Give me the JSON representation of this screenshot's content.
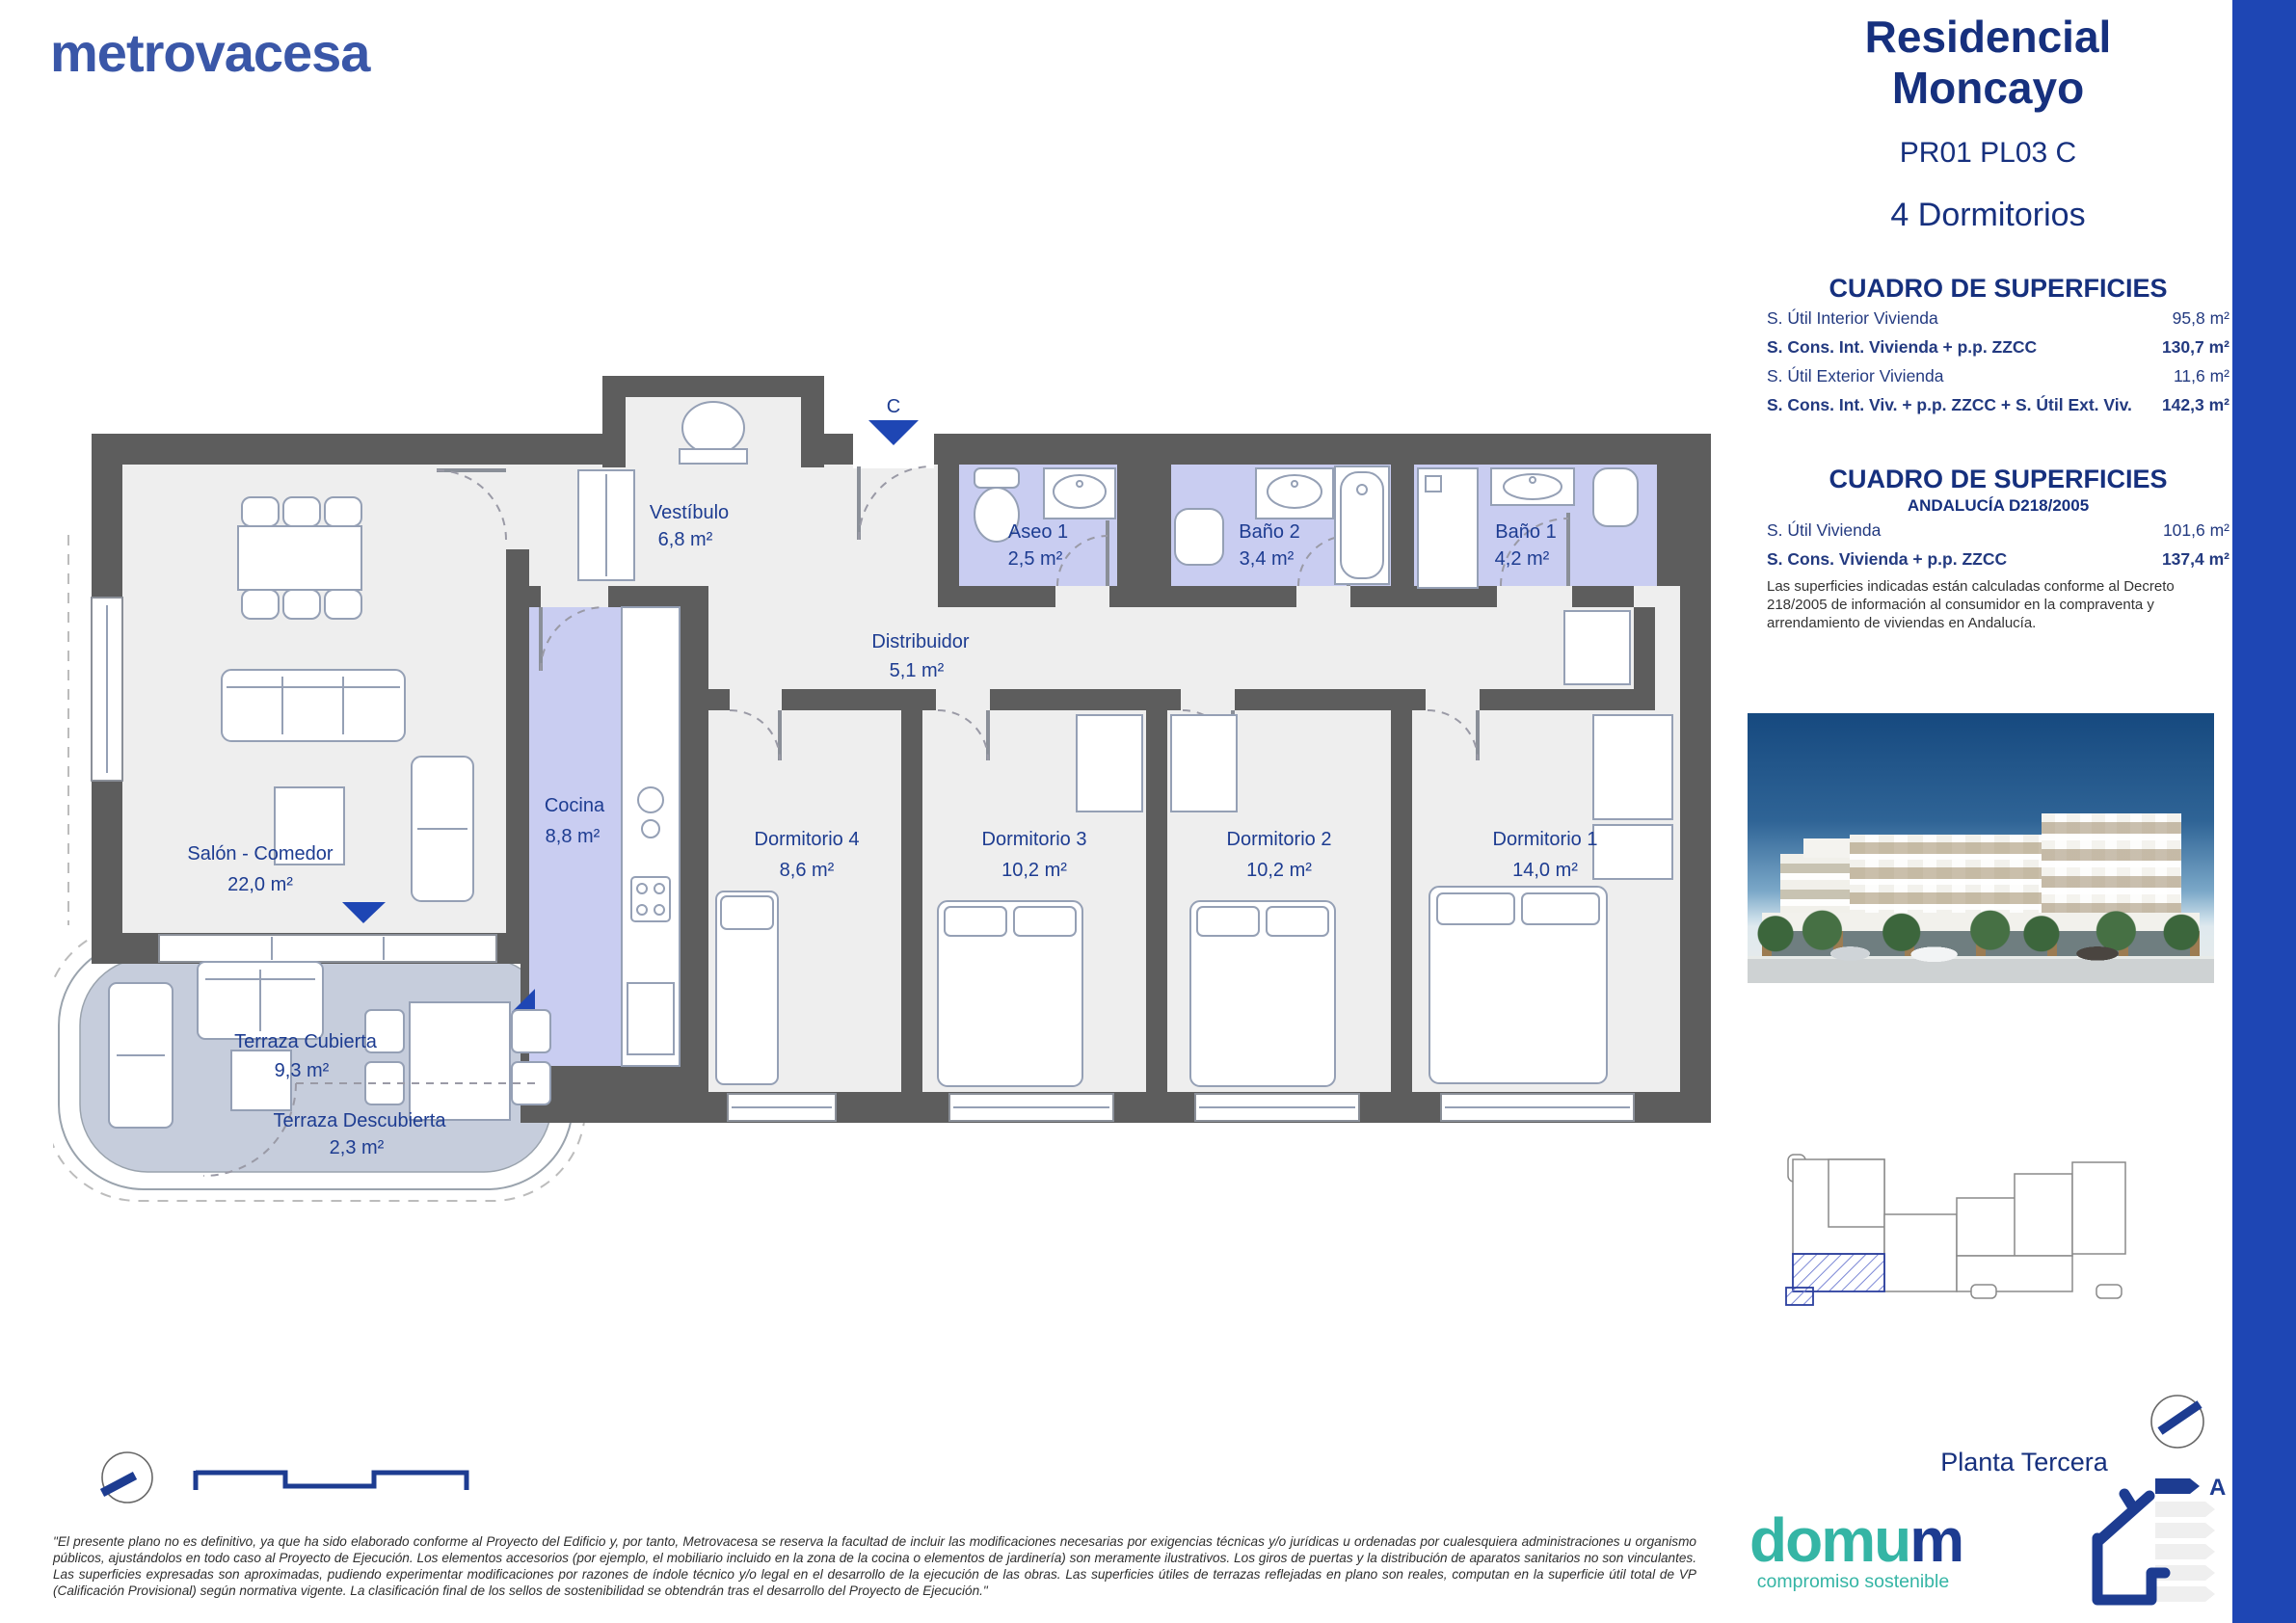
{
  "colors": {
    "accent_bar": "#1e46b4",
    "brand_blue": "#3a57a8",
    "navy": "#16307e",
    "wall_gray": "#5d5d5d",
    "wet_room_lavender": "#c9cdf1",
    "terrace_blue_gray": "#c6cddc",
    "domum_teal": "#35b5a5"
  },
  "brand": {
    "logo_text": "metrovacesa"
  },
  "header": {
    "title_line1": "Residencial",
    "title_line2": "Moncayo",
    "reference": "PR01 PL03 C",
    "bedrooms": "4 Dormitorios"
  },
  "surfaces_table": {
    "title": "CUADRO DE SUPERFICIES",
    "rows": [
      {
        "label": "S. Útil Interior Vivienda",
        "value": "95,8 m²"
      },
      {
        "label": "S. Cons. Int. Vivienda + p.p. ZZCC",
        "value": "130,7 m²"
      },
      {
        "label": "S. Útil Exterior Vivienda",
        "value": "11,6 m²"
      },
      {
        "label": "S. Cons. Int. Viv. + p.p. ZZCC + S. Útil Ext. Viv.",
        "value": "142,3 m²"
      }
    ]
  },
  "andalucia_table": {
    "title": "CUADRO DE SUPERFICIES",
    "subtitle": "ANDALUCÍA D218/2005",
    "rows": [
      {
        "label": "S. Útil Vivienda",
        "value": "101,6 m²"
      },
      {
        "label": "S. Cons. Vivienda + p.p. ZZCC",
        "value": "137,4 m²"
      }
    ],
    "note": "Las superficies indicadas están calculadas conforme al Decreto 218/2005 de información al consumidor en la compraventa y arrendamiento de viviendas en Andalucía."
  },
  "plan": {
    "entrance_label": "C",
    "rooms": [
      {
        "name": "Vestíbulo",
        "area": "6,8 m²"
      },
      {
        "name": "Aseo 1",
        "area": "2,5 m²"
      },
      {
        "name": "Baño 2",
        "area": "3,4 m²"
      },
      {
        "name": "Baño 1",
        "area": "4,2 m²"
      },
      {
        "name": "Distribuidor",
        "area": "5,1 m²"
      },
      {
        "name": "Salón - Comedor",
        "area": "22,0 m²"
      },
      {
        "name": "Cocina",
        "area": "8,8 m²"
      },
      {
        "name": "Dormitorio 4",
        "area": "8,6 m²"
      },
      {
        "name": "Dormitorio 3",
        "area": "10,2 m²"
      },
      {
        "name": "Dormitorio 2",
        "area": "10,2 m²"
      },
      {
        "name": "Dormitorio 1",
        "area": "14,0 m²"
      },
      {
        "name": "Terraza Cubierta",
        "area": "9,3 m²"
      },
      {
        "name": "Terraza Descubierta",
        "area": "2,3 m²"
      }
    ]
  },
  "domum": {
    "part1": "domu",
    "part2": "m",
    "tagline": "compromiso sostenible"
  },
  "footer": {
    "floor_label": "Planta Tercera",
    "energy_rating": "A",
    "disclaimer": "\"El presente plano no es definitivo, ya que ha sido elaborado conforme al Proyecto del Edificio y, por tanto, Metrovacesa se reserva la facultad de incluir las modificaciones necesarias por exigencias técnicas y/o jurídicas u ordenadas por cualesquiera administraciones u organismo públicos, ajustándolos en todo caso al Proyecto de Ejecución. Los elementos accesorios (por ejemplo, el mobiliario incluido en la zona de la cocina o elementos de jardinería) son meramente ilustrativos. Los giros de puertas y la distribución de aparatos sanitarios no son vinculantes. Las superficies expresadas son aproximadas, pudiendo experimentar modificaciones por razones de índole técnico y/o legal en el desarrollo de la ejecución de las obras. Las superficies útiles de terrazas reflejadas en plano son reales, computan en la superficie útil total de VP (Calificación Provisional) según normativa vigente. La clasificación final de los sellos de sostenibilidad se obtendrán tras el desarrollo del Proyecto de Ejecución.\""
  }
}
